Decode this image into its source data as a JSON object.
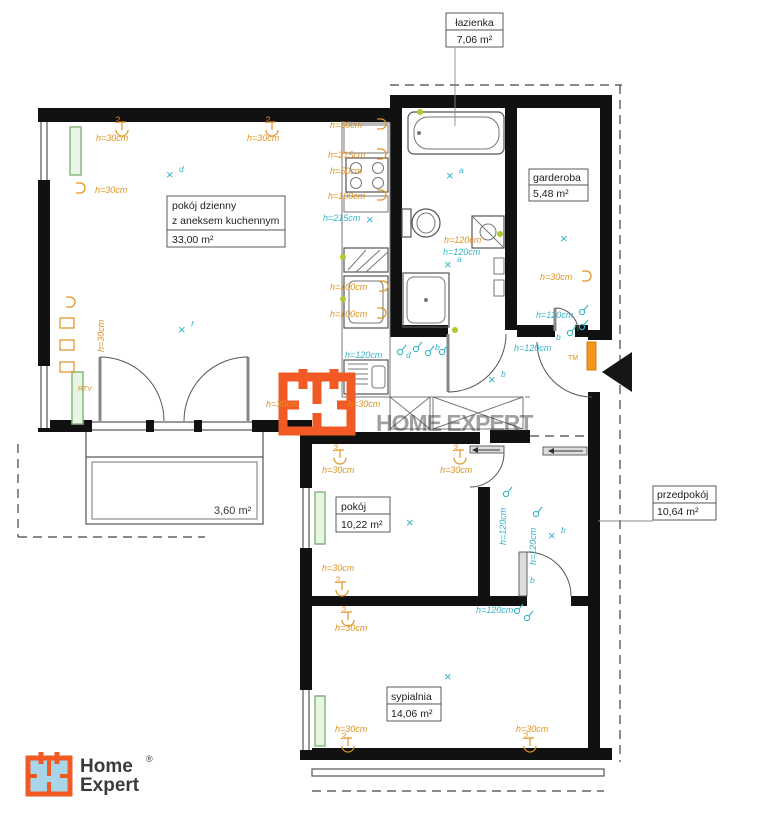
{
  "rooms": {
    "lazienka": {
      "name": "łazienka",
      "area": "7,06 m²"
    },
    "garderoba": {
      "name": "garderoba",
      "area": "5,48 m²"
    },
    "pokoj_dzienny": {
      "name_line1": "pokój dzienny",
      "name_line2": "z aneksem kuchennym",
      "area": "33,00 m²"
    },
    "pokoj": {
      "name": "pokój",
      "area": "10,22 m²"
    },
    "przedpokoj": {
      "name": "przedpokój",
      "area": "10,64 m²"
    },
    "sypialnia": {
      "name": "sypialnia",
      "area": "14,06 m²"
    },
    "balkon": {
      "area": "3,60 m²"
    }
  },
  "heights": {
    "h30": "h=30cm",
    "h50": "h=50cm",
    "h100": "h=100cm",
    "h120": "h=120cm",
    "h215": "h=215cm"
  },
  "symbols": {
    "lamp_count": "2",
    "rtv": "RTV",
    "tm": "TM",
    "cross": "×",
    "letter_a": "a",
    "letter_b": "b",
    "letter_d": "d",
    "letter_f": "f"
  },
  "logo": {
    "line1": "Home",
    "line2": "Expert",
    "registered": "®"
  },
  "watermark": {
    "text": "HOME EXPERT"
  },
  "colors": {
    "annotation_orange": "#e0921e",
    "annotation_cyan": "#35b4c8",
    "logo_orange": "#f15a24",
    "logo_blue": "#a9d5e8",
    "radiator_green": "#86b97e",
    "wall_black": "#111111",
    "accent_dot": "#b5c52e"
  }
}
